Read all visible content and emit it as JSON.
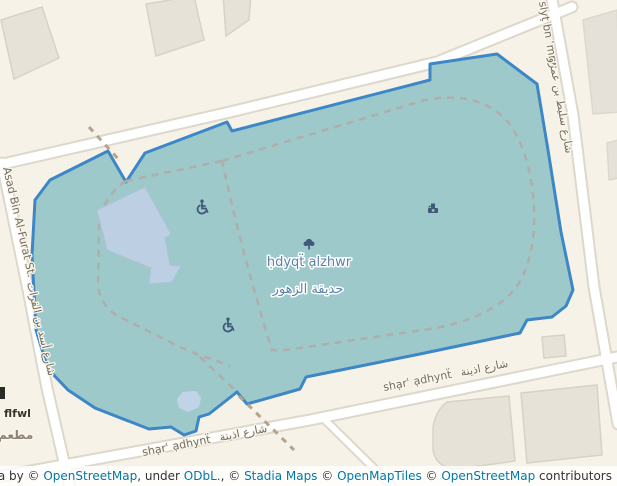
{
  "park": {
    "label_translit": "ḥdyqẗ ạlzhwr",
    "label_arabic": "حديقة الزهور"
  },
  "streets": {
    "asad_bin_alfurat": {
      "label_en": "Asad Bin Al-Furat St.",
      "label_ar": "شارع أسد بن الفرات"
    },
    "slyt_bn_amrw": {
      "label_translit": "slyṭ bn ʿmrw",
      "label_ar": "شارع سليط بن عمرو"
    },
    "shar_adhynt": {
      "label_translit": "shạrʿ ạdhynẗ",
      "label_ar": "شارع اذينة"
    }
  },
  "pois": {
    "flfwl": {
      "label": "flfwl",
      "label_ar": "مطعم"
    }
  },
  "icons": {
    "park_center": "tree-icon",
    "features": [
      "wheelchair-icon",
      "fountain-icon",
      "wheelchair-icon"
    ]
  },
  "attribution": {
    "leaflet": "Leaflet",
    "sep": " | ",
    "data_by": "Data by © ",
    "osm1": "OpenStreetMap",
    "under": ", under ",
    "odbl": "ODbL.",
    "c1": ", © ",
    "stadia": "Stadia Maps",
    "c2": " © ",
    "omt": "OpenMapTiles",
    "c3": " © ",
    "osm2": "OpenStreetMap",
    "contributors": " contributors"
  },
  "colors": {
    "background": "#f7f2e7",
    "park_fill": "#9ec9cb",
    "park_border": "#3d87c6",
    "road_fill": "#ffffff",
    "road_casing": "#ddd8cc",
    "building_fill": "#e7e2d8",
    "building_stroke": "#d8d2c5",
    "inner_building_fill": "#bdd0e3",
    "pond_fill": "#c1d4e7",
    "path_dash_gray": "#aeaeac",
    "path_dash_brown": "#b5a28f",
    "park_label_text": "#5b82a8",
    "street_label_text": "#756d60",
    "icon_color": "#3e5a78",
    "link_color": "#0078a8",
    "attribution_text": "#333333"
  }
}
